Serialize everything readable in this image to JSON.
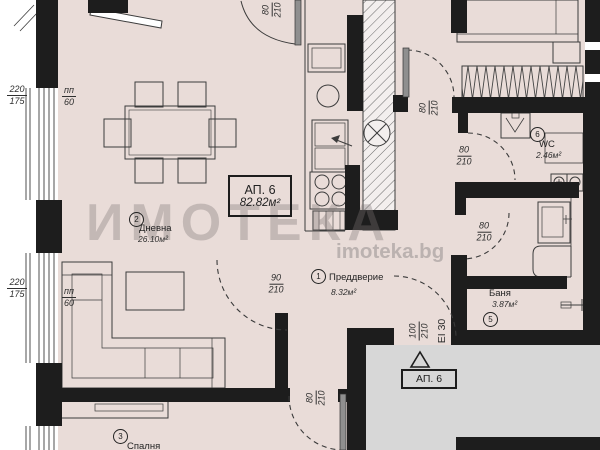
{
  "watermark": {
    "brand": "ИМОТЕКА",
    "site": "imoteka.bg"
  },
  "apartment": {
    "box_title": "АП. 6",
    "box_area": "82.82м²",
    "entrance_label": "АП. 6",
    "entrance_fire": "EI 30"
  },
  "rooms": {
    "hall": {
      "no": "1",
      "name": "Преддверие",
      "area": "8.32м²"
    },
    "living": {
      "no": "2",
      "name": "Дневна",
      "area": "26.10м²"
    },
    "bedroom": {
      "no": "3",
      "name": "Спалня"
    },
    "bath": {
      "no": "5",
      "name": "Баня",
      "area": "3.87м²"
    },
    "wc": {
      "no": "6",
      "name": "WC",
      "area": "2.46м²"
    }
  },
  "windows": {
    "w1": {
      "size": "220",
      "height": "175",
      "sill": "пп",
      "sill_h": "60"
    },
    "w2": {
      "size": "220",
      "height": "175",
      "sill": "пп",
      "sill_h": "60"
    }
  },
  "doors": {
    "top": {
      "w": "80",
      "h": "210"
    },
    "bedroom_top": {
      "w": "80",
      "h": "210"
    },
    "wc": {
      "w": "80",
      "h": "210"
    },
    "bath": {
      "w": "80",
      "h": "210"
    },
    "living": {
      "w": "90",
      "h": "210"
    },
    "entrance": {
      "w": "100",
      "h": "210"
    },
    "bedroom3": {
      "w": "80",
      "h": "210"
    }
  },
  "colors": {
    "wall": "#1d1d1d",
    "interior": "#e9dcd8",
    "corridor": "#d7d7d7"
  }
}
